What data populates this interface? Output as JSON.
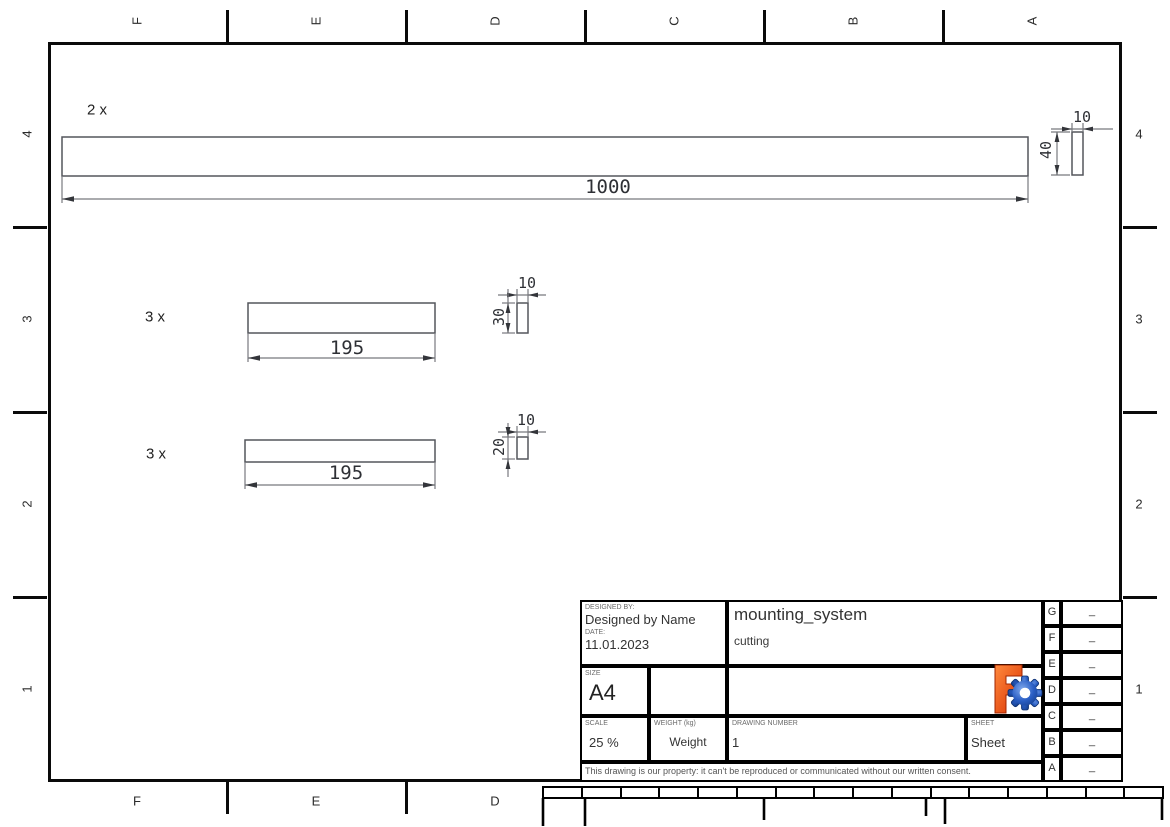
{
  "grid": {
    "top_letters": [
      "F",
      "E",
      "D",
      "C",
      "B",
      "A"
    ],
    "bottom_letters": [
      "F",
      "E",
      "D"
    ],
    "left_numbers": [
      "4",
      "3",
      "2",
      "1"
    ],
    "right_numbers": [
      "4",
      "3",
      "2",
      "1"
    ]
  },
  "drawing": {
    "parts": [
      {
        "qty": "2 x",
        "length": "1000",
        "width": "10",
        "height": "40"
      },
      {
        "qty": "3 x",
        "length": "195",
        "width": "10",
        "height": "30"
      },
      {
        "qty": "3 x",
        "length": "195",
        "width": "10",
        "height": "20"
      }
    ]
  },
  "title_block": {
    "designed_by_label": "DESIGNED BY:",
    "designed_by": "Designed by Name",
    "date_label": "DATE:",
    "date": "11.01.2023",
    "size_label": "SIZE",
    "size": "A4",
    "title": "mounting_system",
    "subtitle": "cutting",
    "scale_label": "SCALE",
    "scale": "25 %",
    "weight_label": "WEIGHT (kg)",
    "weight": "Weight",
    "drawing_number_label": "DRAWING NUMBER",
    "drawing_number": "1",
    "sheet_label": "SHEET",
    "sheet": "Sheet",
    "disclaimer": "This drawing is our property: it can't be reproduced or communicated without our written consent.",
    "revision_rows": [
      {
        "letter": "G",
        "value": "_"
      },
      {
        "letter": "F",
        "value": "_"
      },
      {
        "letter": "E",
        "value": "_"
      },
      {
        "letter": "D",
        "value": "_"
      },
      {
        "letter": "C",
        "value": "_"
      },
      {
        "letter": "B",
        "value": "_"
      },
      {
        "letter": "A",
        "value": "_"
      }
    ]
  },
  "colors": {
    "frame": "#000000",
    "drawing_line": "#54565c",
    "logo_orange": "#e8420a",
    "logo_blue": "#2a5ec4"
  }
}
